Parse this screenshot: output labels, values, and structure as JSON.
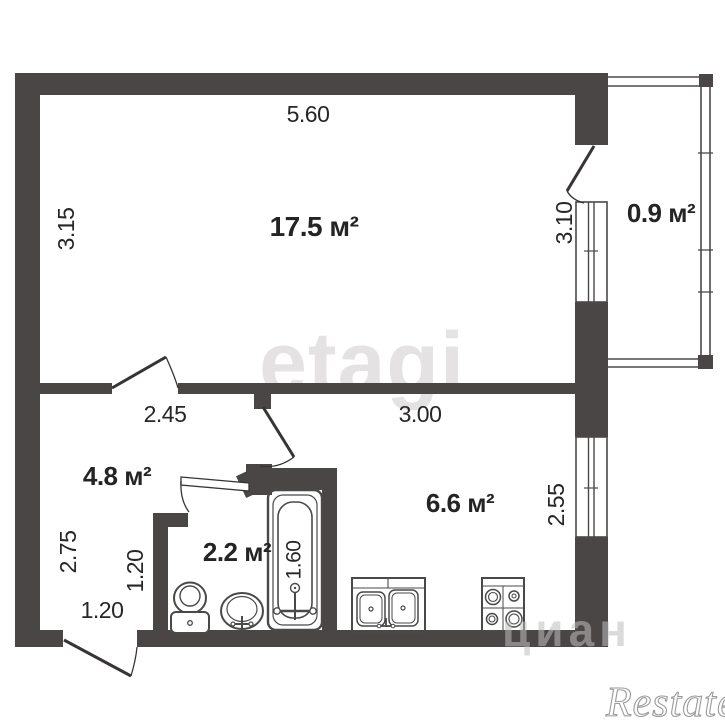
{
  "plan": {
    "rooms": {
      "living": {
        "area": "17.5 м²"
      },
      "balcony": {
        "area": "0.9 м²"
      },
      "hallway": {
        "area": "4.8 м²"
      },
      "bathroom": {
        "area": "2.2 м²"
      },
      "kitchen": {
        "area": "6.6 м²"
      }
    },
    "dimensions": {
      "living_top": "5.60",
      "living_left": "3.15",
      "balcony_window": "3.10",
      "hallway_top": "2.45",
      "kitchen_top": "3.00",
      "kitchen_right": "2.55",
      "hallway_left": "2.75",
      "hallway_inner": "1.20",
      "entrance": "1.20",
      "bathtub_length": "1.60"
    },
    "watermarks": {
      "agency": "etagi",
      "portal": "циан",
      "corner": "Restate"
    },
    "colors": {
      "wall": "#4a4646",
      "line": "#4b4848",
      "text": "#262626",
      "watermark_light": "#e4e2e2",
      "watermark_gray": "#bebebe",
      "script_gray": "#9a9a9a"
    }
  }
}
